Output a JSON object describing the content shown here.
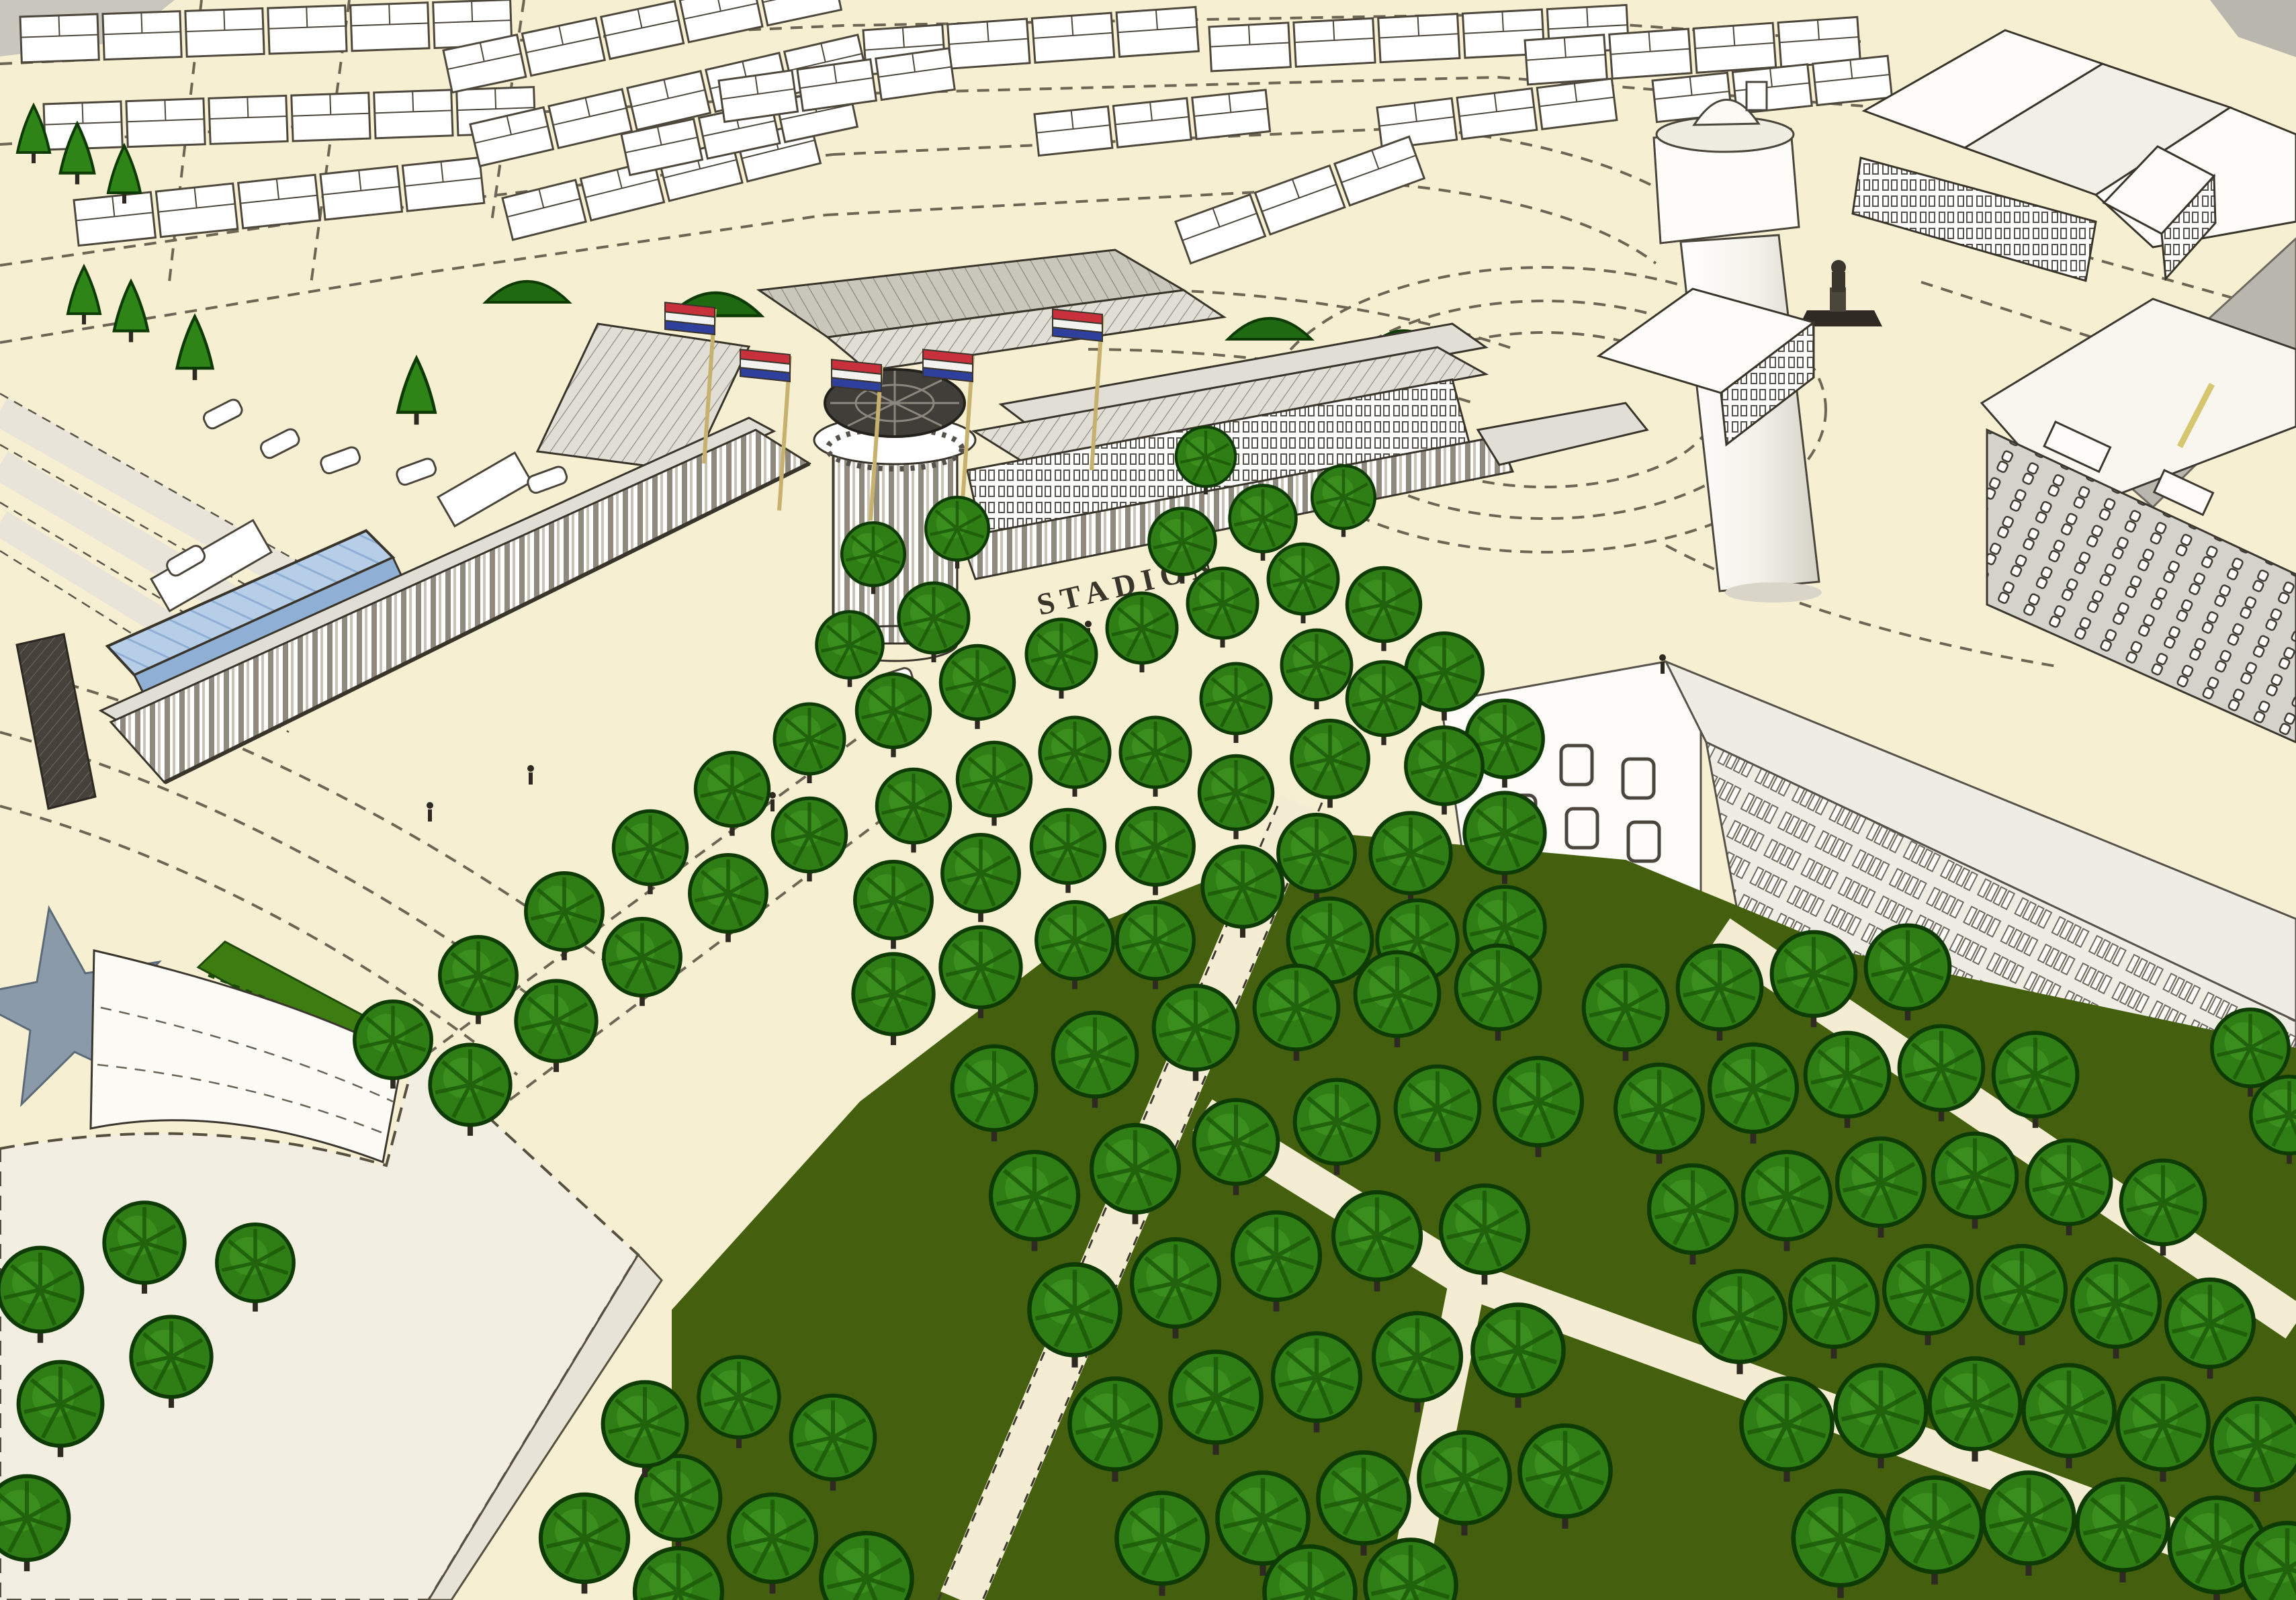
{
  "scene": {
    "kind": "aerial-3d-city-model-rendering",
    "landmark_sign": "STADION",
    "flag_count": 5,
    "flag_type": "dutch-tricolor"
  },
  "labels": {
    "stadion": "STADION"
  },
  "colors": {
    "background": "#f7efd2",
    "ink": "#3a352b",
    "roof_gray": "#e0ded5",
    "roof_gray_dark": "#c9c6bc",
    "wall_white": "#ffffff",
    "lawn_green": "#44600f",
    "tree_green": "#2f7e15",
    "tree_green_light": "#429a24",
    "tree_green_dark": "#1c5808",
    "tree_outline": "#0e3a04",
    "hedge_green": "#3c7c10",
    "bush_green": "#1f6a10",
    "cone_green": "#2e8416",
    "canopy_blue": "#b7cee9",
    "canopy_stripe": "#8fafd4",
    "flag_red": "#c8313c",
    "flag_white": "#f2f2ef",
    "flag_blue": "#2e3f9c",
    "pole_tan": "#c6b26e",
    "star_gray": "#8b9aa9",
    "rail_gray": "#e8e4d9",
    "road_gray": "#b9b6ae",
    "slab_wall": "#efece4",
    "apartment_gray": "#d3d2cb",
    "drum_dark": "#403e38",
    "foreground_roof": "#f2eee2",
    "crane_yellow": "#d6c66f",
    "path_cream": "#f4edd3"
  }
}
